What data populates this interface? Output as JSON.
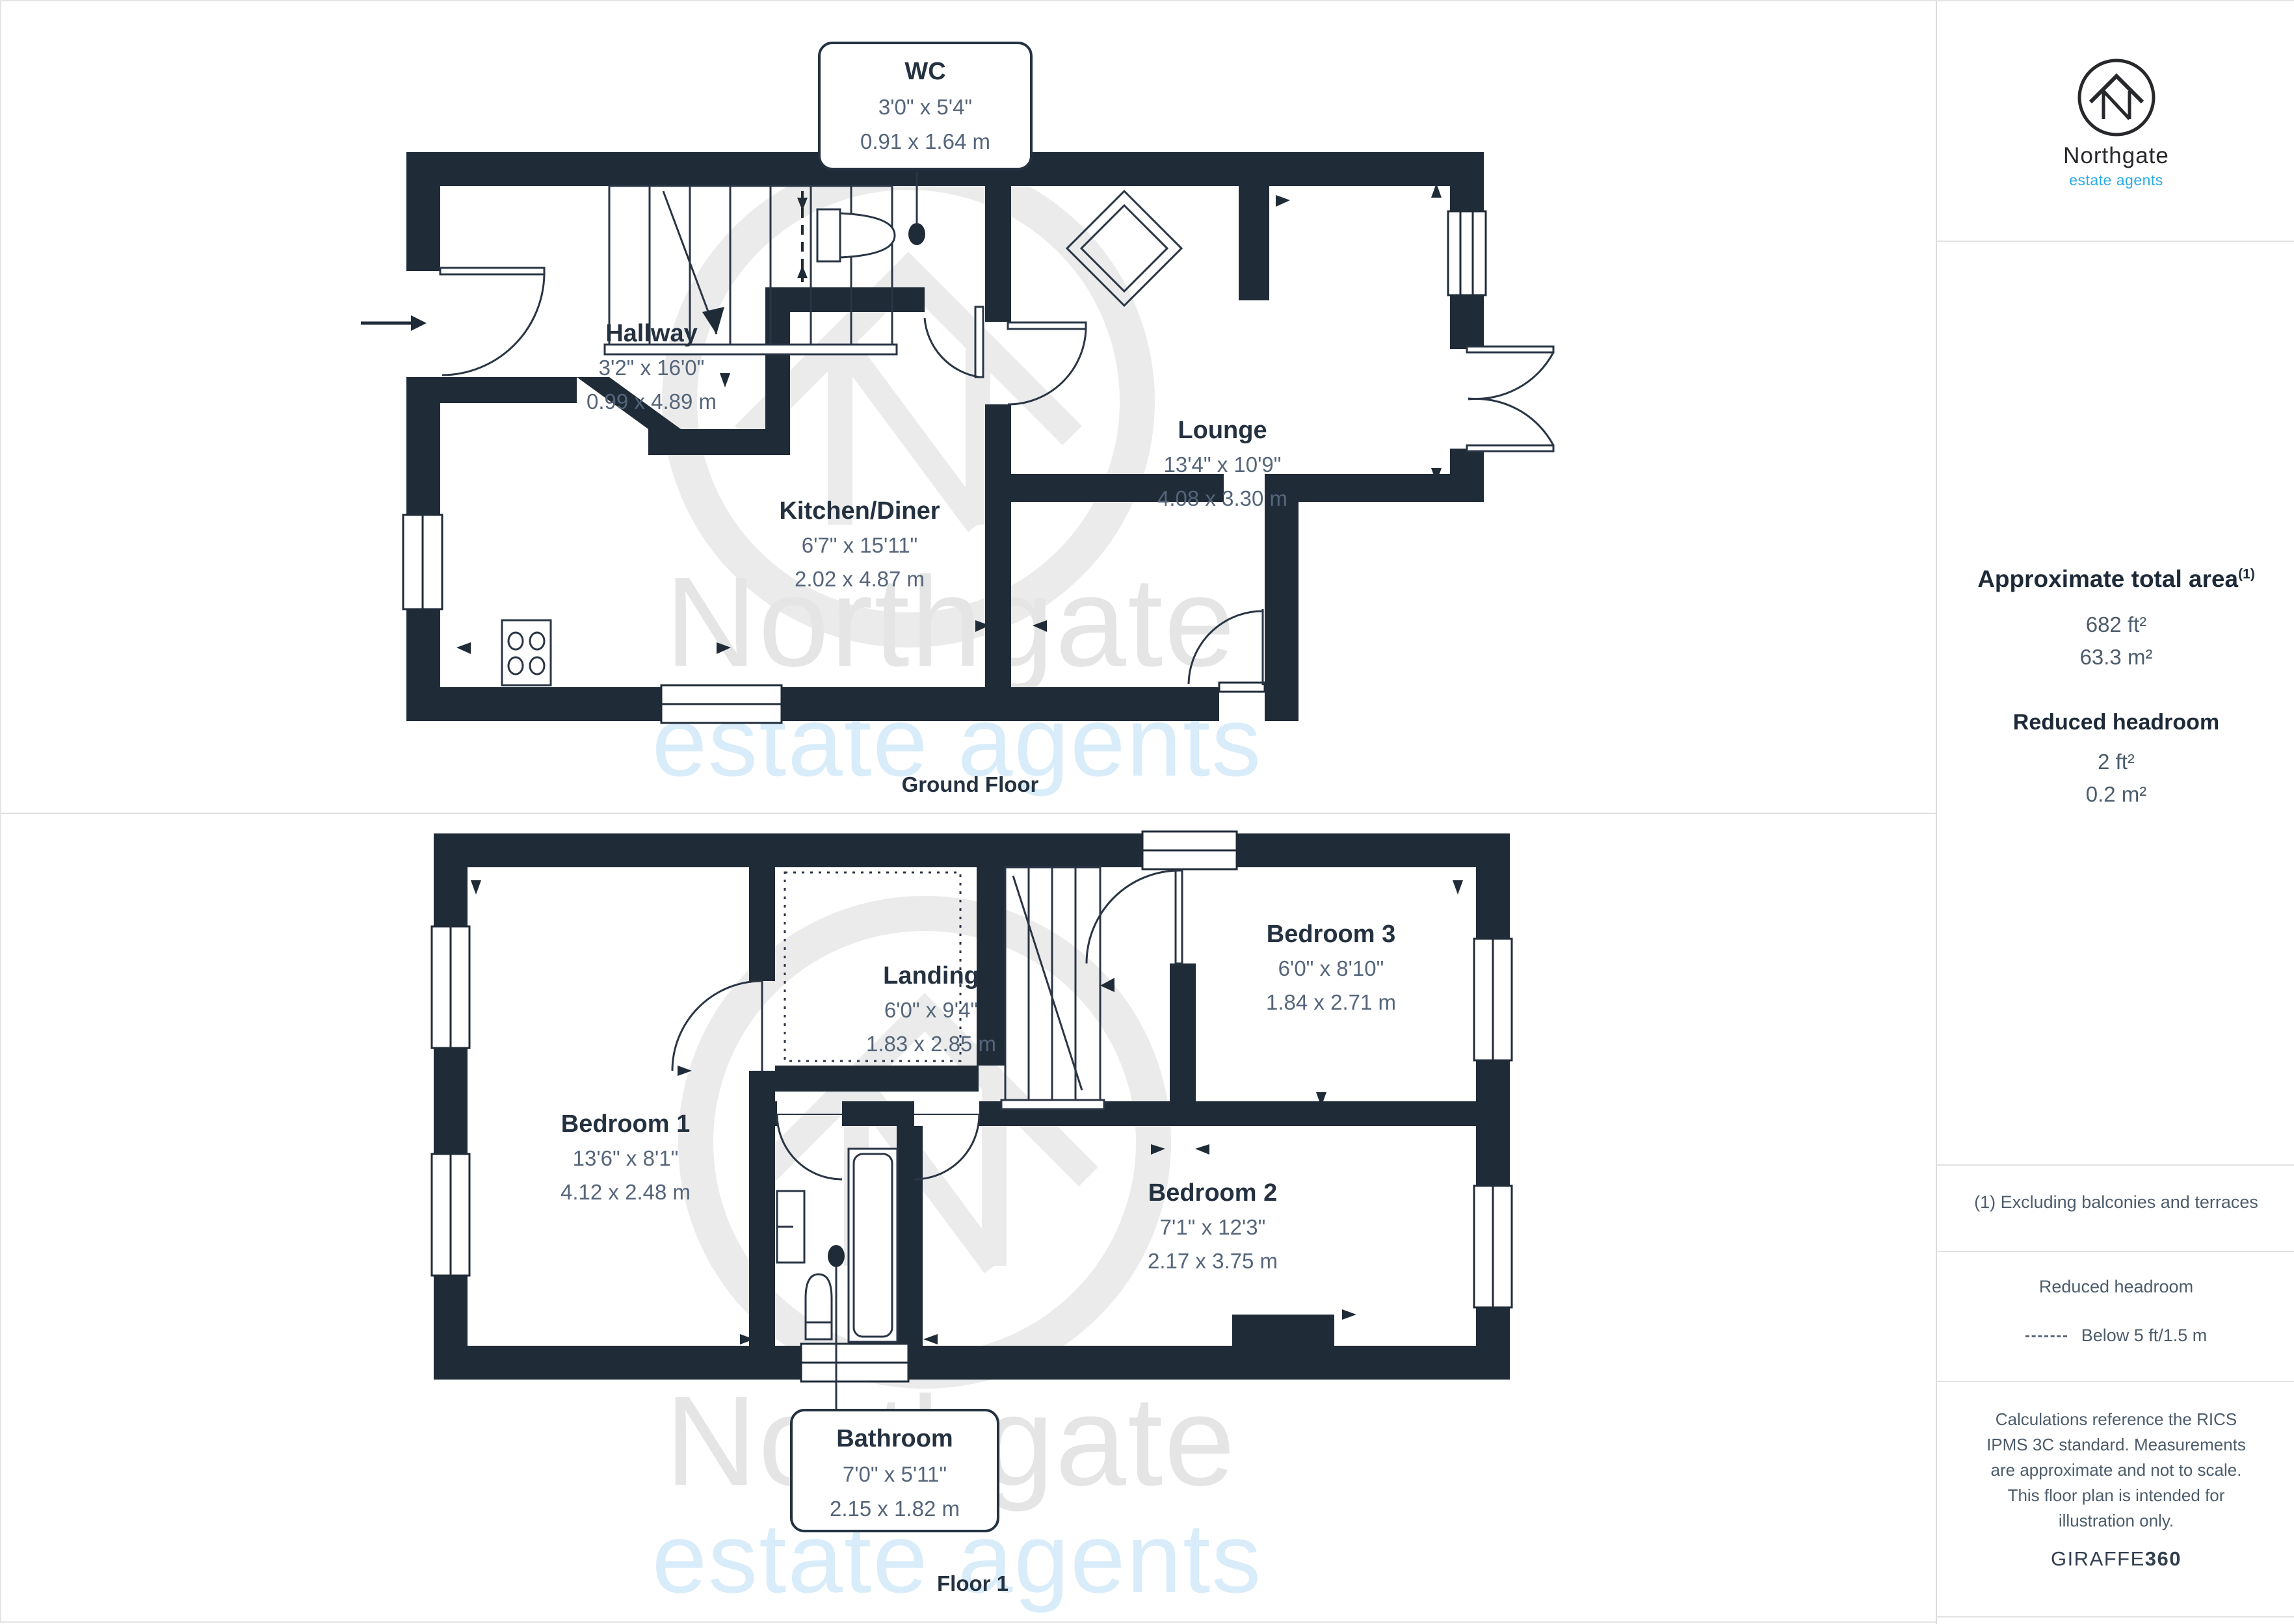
{
  "watermark": {
    "name": "Northgate",
    "tagline": "estate agents"
  },
  "logo": {
    "name": "Northgate",
    "tagline": "estate agents"
  },
  "floors": [
    {
      "caption": "Ground Floor",
      "rooms": [
        {
          "name": "WC",
          "imperial": "3'0\" x 5'4\"",
          "metric": "0.91 x 1.64 m"
        },
        {
          "name": "Hallway",
          "imperial": "3'2\" x 16'0\"",
          "metric": "0.99 x 4.89 m"
        },
        {
          "name": "Kitchen/Diner",
          "imperial": "6'7\" x 15'11\"",
          "metric": "2.02 x 4.87 m"
        },
        {
          "name": "Lounge",
          "imperial": "13'4\" x 10'9\"",
          "metric": "4.08 x 3.30 m"
        }
      ]
    },
    {
      "caption": "Floor 1",
      "rooms": [
        {
          "name": "Bedroom 1",
          "imperial": "13'6\" x 8'1\"",
          "metric": "4.12 x 2.48 m"
        },
        {
          "name": "Landing",
          "imperial": "6'0\" x 9'4\"",
          "metric": "1.83 x 2.85 m"
        },
        {
          "name": "Bedroom 3",
          "imperial": "6'0\" x 8'10\"",
          "metric": "1.84 x 2.71 m"
        },
        {
          "name": "Bedroom 2",
          "imperial": "7'1\" x 12'3\"",
          "metric": "2.17 x 3.75 m"
        },
        {
          "name": "Bathroom",
          "imperial": "7'0\" x 5'11\"",
          "metric": "2.15 x 1.82 m"
        }
      ]
    }
  ],
  "sidebar": {
    "area_title": "Approximate total area",
    "area_title_sup": "(1)",
    "area_ft": "682 ft²",
    "area_m": "63.3 m²",
    "reduced_title": "Reduced headroom",
    "reduced_ft": "2 ft²",
    "reduced_m": "0.2 m²",
    "footnote": "(1) Excluding balconies and terraces",
    "legend_title": "Reduced headroom",
    "legend_value": "Below 5 ft/1.5 m",
    "disclaimer": "Calculations reference the RICS IPMS 3C standard. Measurements are approximate and not to scale. This floor plan is intended for illustration only.",
    "brand": "GIRAFFE",
    "brand_suffix": "360"
  },
  "colors": {
    "wall": "#202b38",
    "accent_blue": "#29abe2",
    "dim_text": "#55657a"
  }
}
